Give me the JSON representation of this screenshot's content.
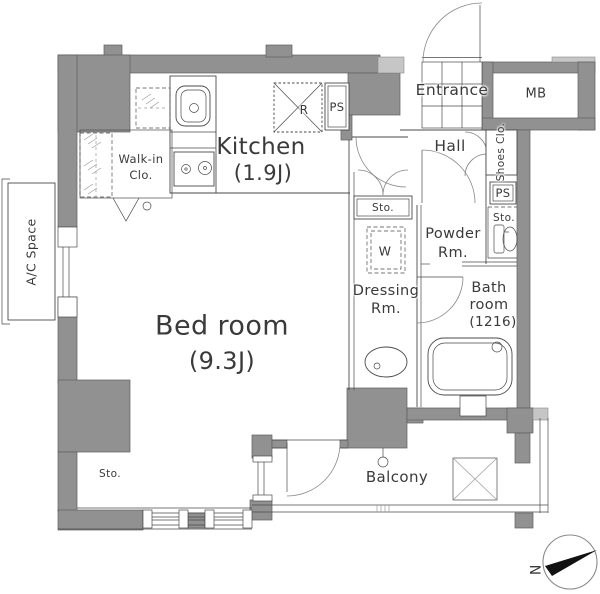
{
  "plan": {
    "rooms": {
      "bedroom": {
        "name": "Bed room",
        "size": "(9.3J)"
      },
      "kitchen": {
        "name": "Kitchen",
        "size": "(1.9J)"
      },
      "walkin": {
        "line1": "Walk-in",
        "line2": "Clo."
      },
      "entrance": {
        "name": "Entrance"
      },
      "mb": {
        "name": "MB"
      },
      "hall": {
        "name": "Hall"
      },
      "shoes": {
        "name": "Shoes Clo."
      },
      "powder": {
        "line1": "Powder",
        "line2": "Rm."
      },
      "dressing": {
        "line1": "Dressing",
        "line2": "Rm."
      },
      "bath": {
        "line1": "Bath",
        "line2": "room",
        "line3": "(1216)"
      },
      "balcony": {
        "name": "Balcony"
      },
      "ac_space": {
        "name": "A/C Space"
      }
    },
    "labels": {
      "refrigerator": "R",
      "ps_kitchen": "PS",
      "ps_hall": "PS",
      "sto_kitchen": "Sto.",
      "sto_toilet": "Sto.",
      "sto_bedroom": "Sto.",
      "washer": "W",
      "compass_north": "N"
    },
    "colors": {
      "wall": "#919191",
      "wall_light": "#c6c6c6",
      "line": "#4a4a4a",
      "text": "#3a3a3a"
    }
  }
}
